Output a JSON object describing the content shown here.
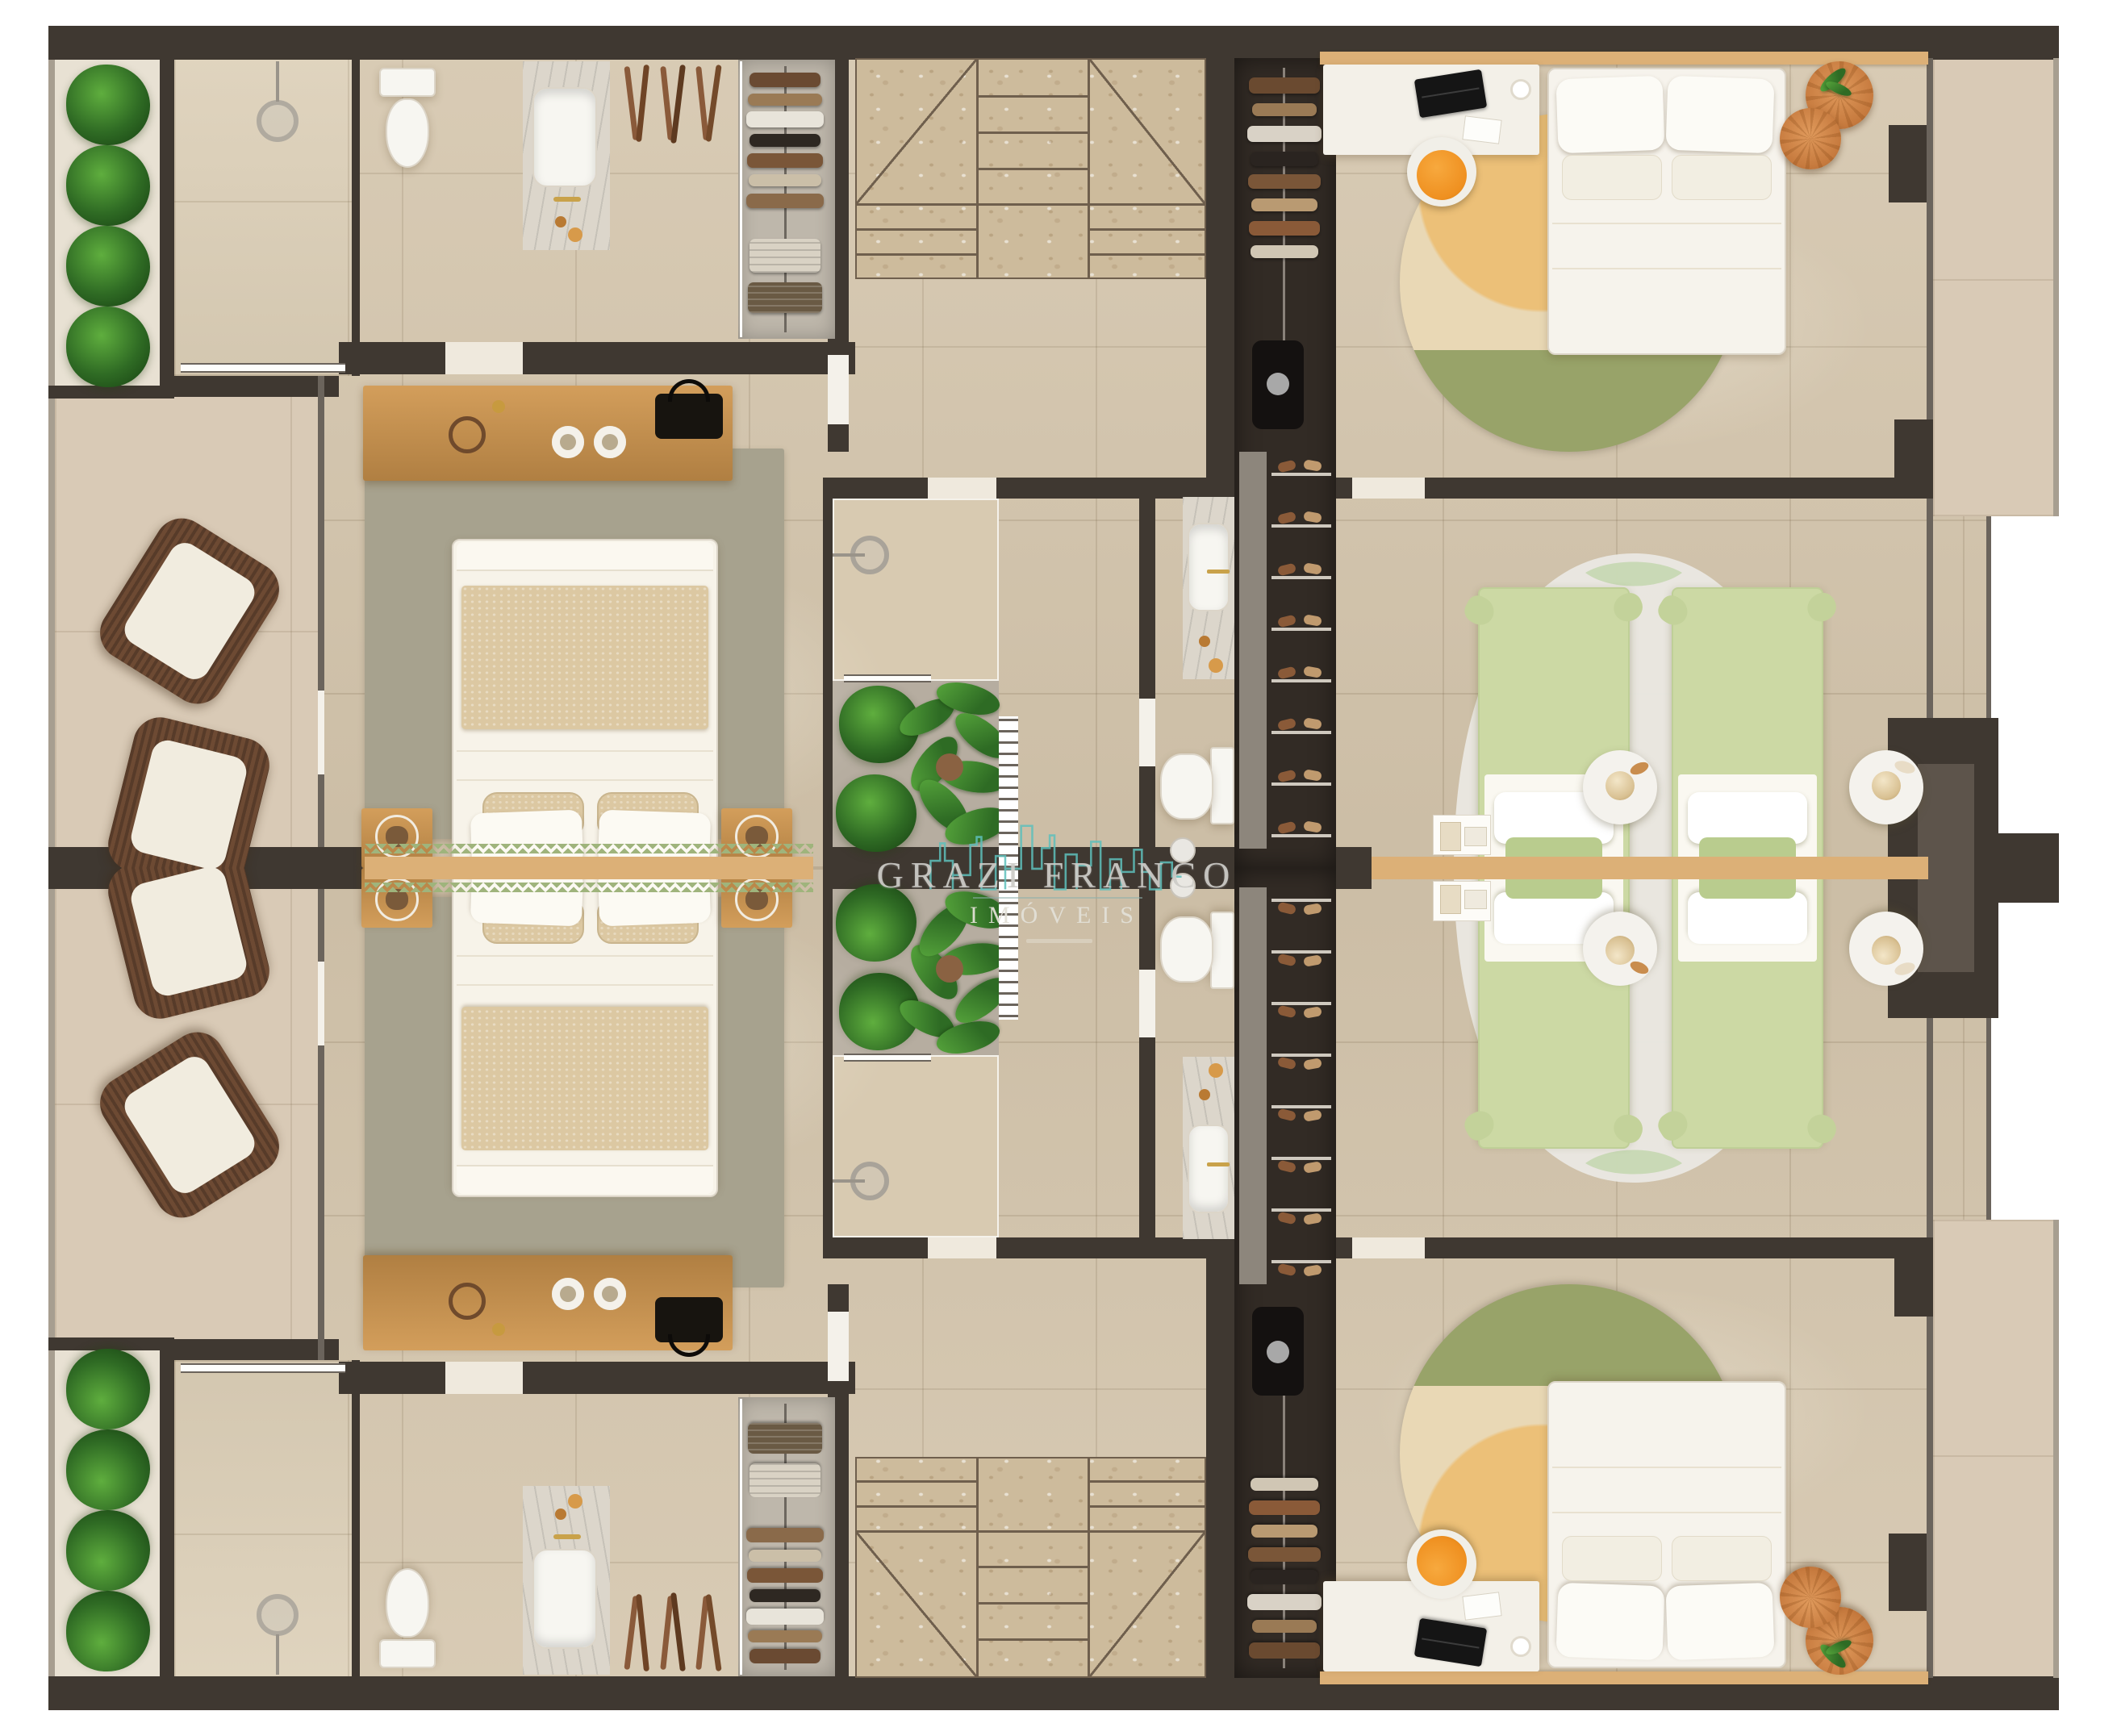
{
  "watermark": {
    "brand": "GRAZI FRANCO",
    "subtitle": "IMÓVEIS"
  },
  "palette": {
    "wall": "#3f3831",
    "wallSoft": "#6b645c",
    "railGray": "#a79e90",
    "floor": "#d4c5ac",
    "floorLight": "#e8e1d3",
    "balcony": "#d9cab6",
    "atrium": "#b6ada0",
    "marble": "#cdbb9c",
    "marbleLine": "#6f5f4d",
    "wood": "#c9914f",
    "woodLight": "#dcb077",
    "rugSage": "#a7a28e",
    "bedBeige": "#dcc8a2",
    "greenBed": "#ccd9a4",
    "greenPillow": "#b9cc8e",
    "rugGreenWave": "#b8cfa1",
    "rugCream": "#e9d8b5",
    "rugYellow": "#ecc078",
    "rugOlive": "#98a369",
    "chairOrange": "#ef9020",
    "pouf": "#d4884c",
    "plant": "#3f8a2f",
    "closet": "#322b25",
    "teal": "#5ec0bb",
    "trim": "#9fb47c",
    "watermarkText": "#cccbc7"
  },
  "counts": {
    "mirrored_units": 2,
    "planter_bushes": 4,
    "atrium_plants": 3,
    "closet_shoe_shelves": 8,
    "lounge_chairs": 2,
    "double_beds": 2,
    "twin_beds": 2,
    "pouf_ottomans": 2,
    "stair_winders": 2
  }
}
